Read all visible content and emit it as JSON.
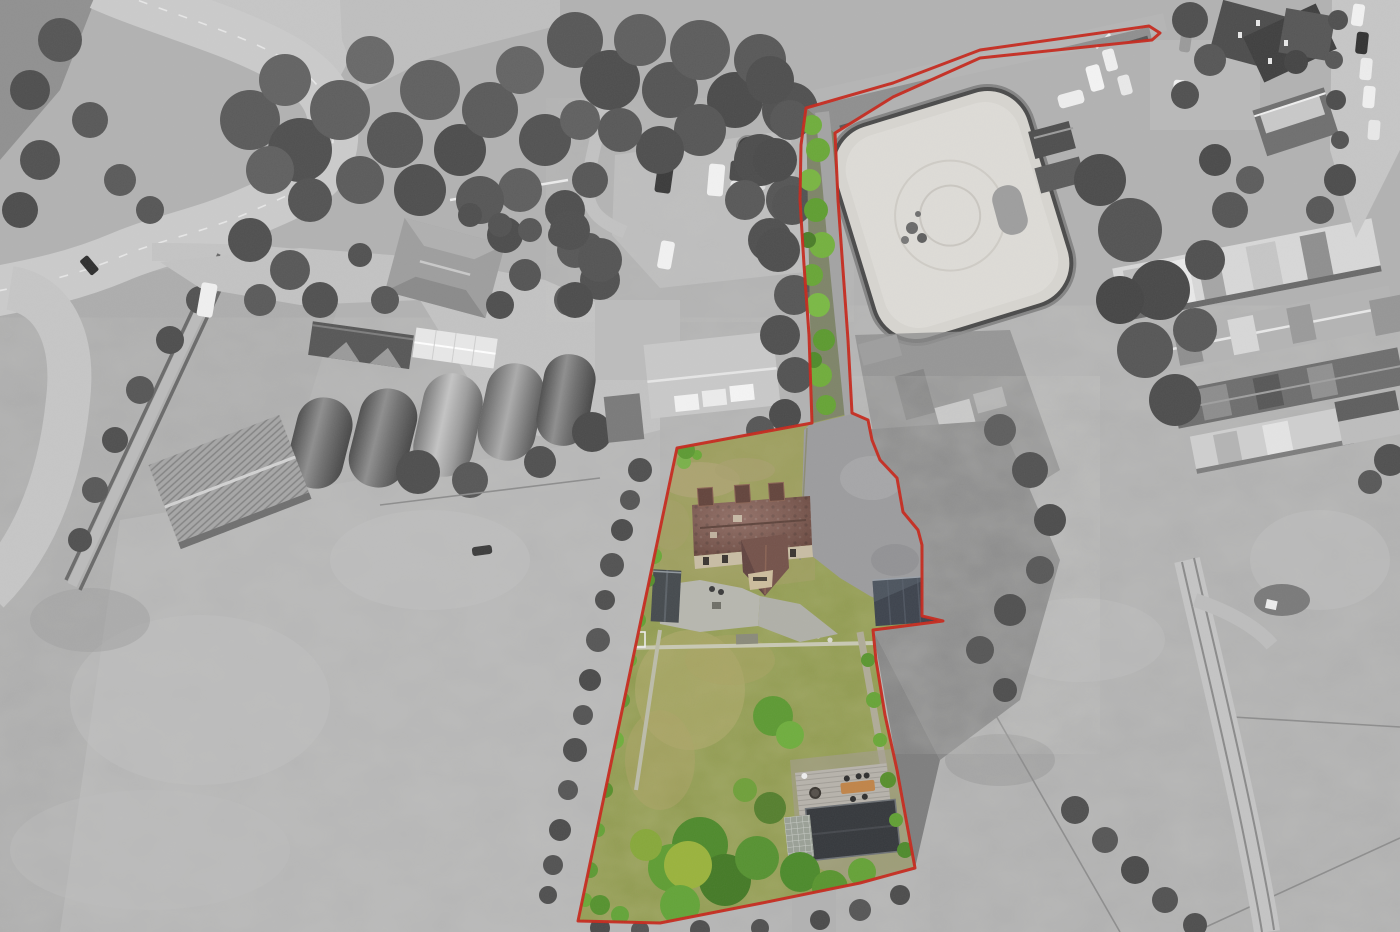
{
  "scene": {
    "type": "aerial-drone-photograph",
    "description": "Overhead drone photo of a rural property for sale: the lot (farmhouse, gardens, driveway, access lane and a roadside strip) is outlined in red and rendered in colour, while all surrounding land - farmyard, Nissen huts, riding arena, stable barns, roads and grazing fields - is desaturated to grayscale.",
    "width_px": 1400,
    "height_px": 932
  },
  "boundary": {
    "color": "#c6281c",
    "stroke_width": 3,
    "points": "1149,26 980,50 893,83 806,108 801,145 800,200 804,265 809,335 812,423 677,448 578,921 660,923 762,903 860,883 915,868 908,830 897,770 885,715 876,660 873,630 943,621 922,616 922,545 918,530 903,512 897,478 880,460 872,440 868,420 852,413 848,340 843,270 838,200 835,133 893,97 980,58 1152,40 1160,33"
  },
  "palette": {
    "base_gray": "#b2b2b2",
    "road_gray": "#c9c9c9",
    "canopy_gray": "#555555",
    "arena_sand": "#d7d5d0",
    "lawn_green": "#8f9a4e",
    "tree_green": "#5d9a33",
    "roof_brown": "#7b5146",
    "garage_slate": "#3d434d",
    "deck_gray": "#b7b3ab",
    "table_orange": "#c08448",
    "summerhouse_charcoal": "#35383c"
  },
  "features": {
    "property": [
      "red boundary outline",
      "brick farmhouse with three dormers and front gable",
      "stone patio",
      "asphalt driveway and forecourt",
      "slate-roofed garage",
      "timber shed",
      "two lawns split by a footpath",
      "timber deck with orange picnic table",
      "charcoal summerhouse",
      "greenhouse",
      "mature green trees and hedges",
      "tree-lined access lane",
      "narrow roadside access strip running north-east"
    ],
    "surroundings": [
      "S-bend country road top left",
      "dense grey tree canopy",
      "farmyard with five Nissen-hut barns and corrugated workshop",
      "hip-roofed house and white outbuilding",
      "gravel car park with vans, trailers and a trampoline",
      "sand horse-riding arena",
      "long stable and industrial barns on the right",
      "horse-box trailers parked along the lane",
      "village houses and parked cars top right",
      "open fields with worn tracks, fences and hedgerows"
    ]
  }
}
